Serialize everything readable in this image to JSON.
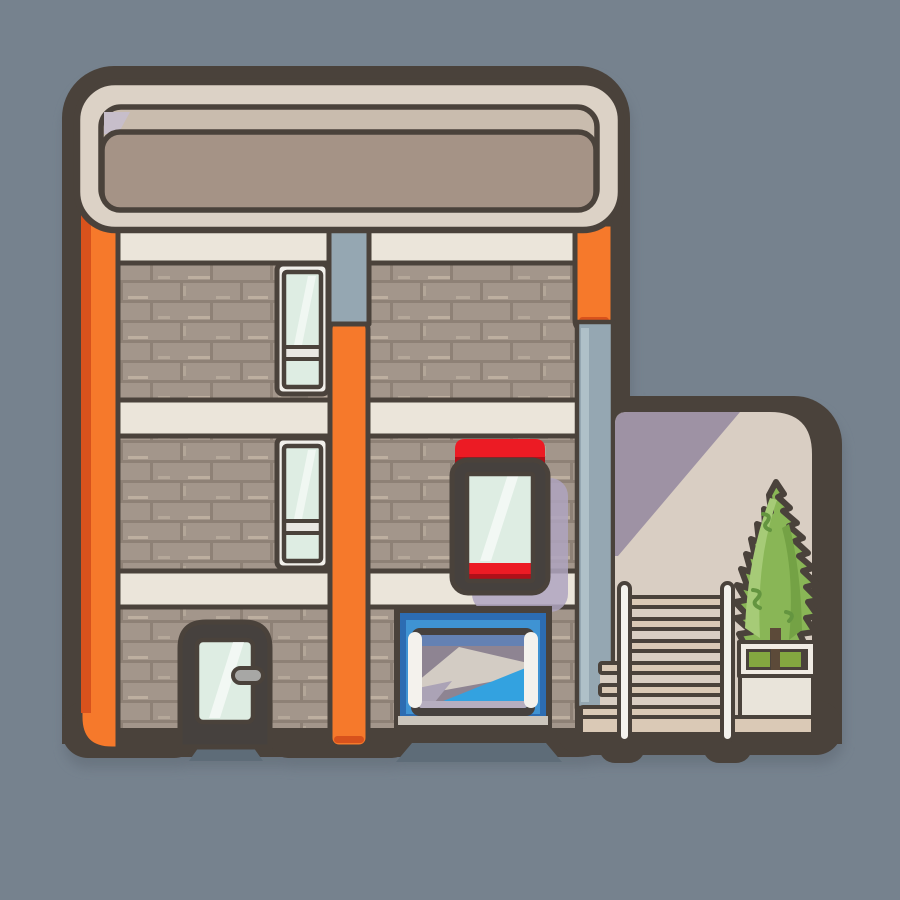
{
  "scene": {
    "title": "Flat cartoon illustration of a three-story brick apartment building with orange pillars, a blank rounded roof signboard, a red display window, a blue glass entrance, a small side door, and a right-hand annex with an outdoor staircase, white railing posts, and a conifer tree in a white planter",
    "style": "flat sticker illustration, thick umber outlines, soft drop shadow",
    "building": {
      "floors": 3,
      "roof_sign": "large blank rounded taupe signboard",
      "left_windows": 2,
      "red_display_window": 1,
      "entrance": "blue-framed double glass door with two white handles",
      "side_door": "small dark-framed glass door with grey handle",
      "annex": "stair annex with three-rail railing, two white posts, planter box with hedge grass and conifer tree"
    }
  },
  "colors": {
    "background": "#76828E",
    "drop_shadow": "#67727E",
    "outline": "#4A423B",
    "header_outer": "#DCD2C6",
    "header_strip": "#C9BCAE",
    "header_corner": "#C7BECA",
    "header_face": "#A59386",
    "band": "#EBE5DA",
    "brick": "#A3968B",
    "mortar_dark": "#8C7F73",
    "mortar_light": "#C3B5A5",
    "orange": "#F6792B",
    "orange_dark": "#D8521C",
    "pipe": "#95A7B2",
    "pipe_light": "#AFC0C8",
    "window_frame": "#F1EFEA",
    "glass": "#DEEDE3",
    "glass_band": "#E9E7E2",
    "red": "#EC1B24",
    "red_dark": "#AF1019",
    "dark_frame": "#46413E",
    "sign_shadow": "#AFA5C0",
    "blue_frame": "#2C6CB2",
    "blue_frame_light": "#3F93D3",
    "interior_purple": "#8E8492",
    "interior_top_blue": "#5580BD",
    "interior_lavender": "#ABA3B6",
    "interior_light": "#D3CCC4",
    "interior_blue": "#33A2E0",
    "interior_sill": "#B6AEC0",
    "threshold": "#CBC5BC",
    "handle_grey": "#A7A7A5",
    "annex_wall": "#D9CEC3",
    "annex_shade": "#9E92A4",
    "stair_tread": "#DAC9B6",
    "railing_white": "#F4F2ED",
    "planter_white": "#F0EBE3",
    "planter_grass": "#83A740",
    "tree_trunk": "#5C4A39",
    "pedestal": "#E9E4DA",
    "tree_light": "#A6CB77",
    "tree_mid": "#89B656",
    "tree_dark": "#74A245",
    "tree_accent": "#649540",
    "mat": "#5E6C78"
  }
}
